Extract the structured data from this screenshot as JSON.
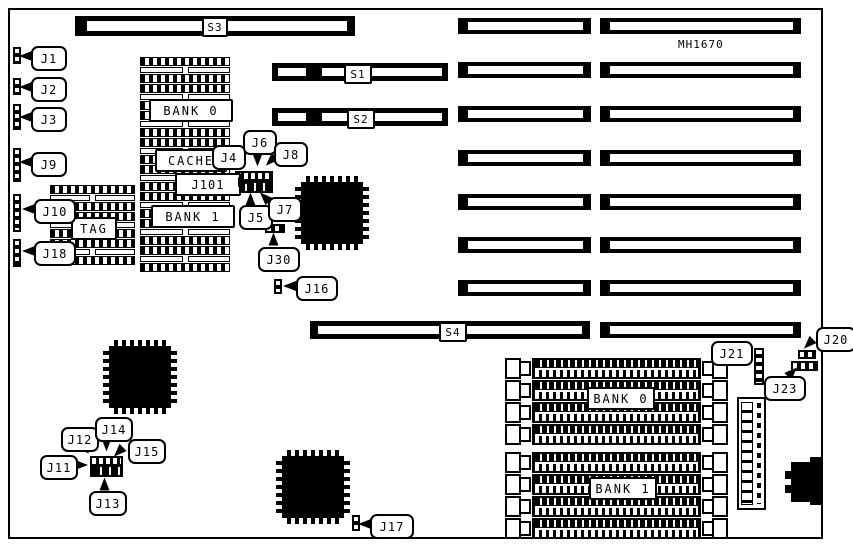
{
  "board": {
    "model_number": "MH1670"
  },
  "slots": {
    "s1": "S1",
    "s2": "S2",
    "s3": "S3",
    "s4": "S4"
  },
  "memory": {
    "dip_bank0": "BANK 0",
    "cache": "CACHE",
    "dip_bank1": "BANK 1",
    "tag": "TAG",
    "simm_bank0": "BANK 0",
    "simm_bank1": "BANK 1"
  },
  "jumpers": {
    "j1": "J1",
    "j2": "J2",
    "j3": "J3",
    "j4": "J4",
    "j5": "J5",
    "j6": "J6",
    "j7": "J7",
    "j8": "J8",
    "j9": "J9",
    "j10": "J10",
    "j11": "J11",
    "j12": "J12",
    "j13": "J13",
    "j14": "J14",
    "j15": "J15",
    "j16": "J16",
    "j17": "J17",
    "j18": "J18",
    "j20": "J20",
    "j21": "J21",
    "j23": "J23",
    "j30": "J30",
    "j101": "J101"
  },
  "colors": {
    "ink": "#000000",
    "paper": "#ffffff"
  }
}
